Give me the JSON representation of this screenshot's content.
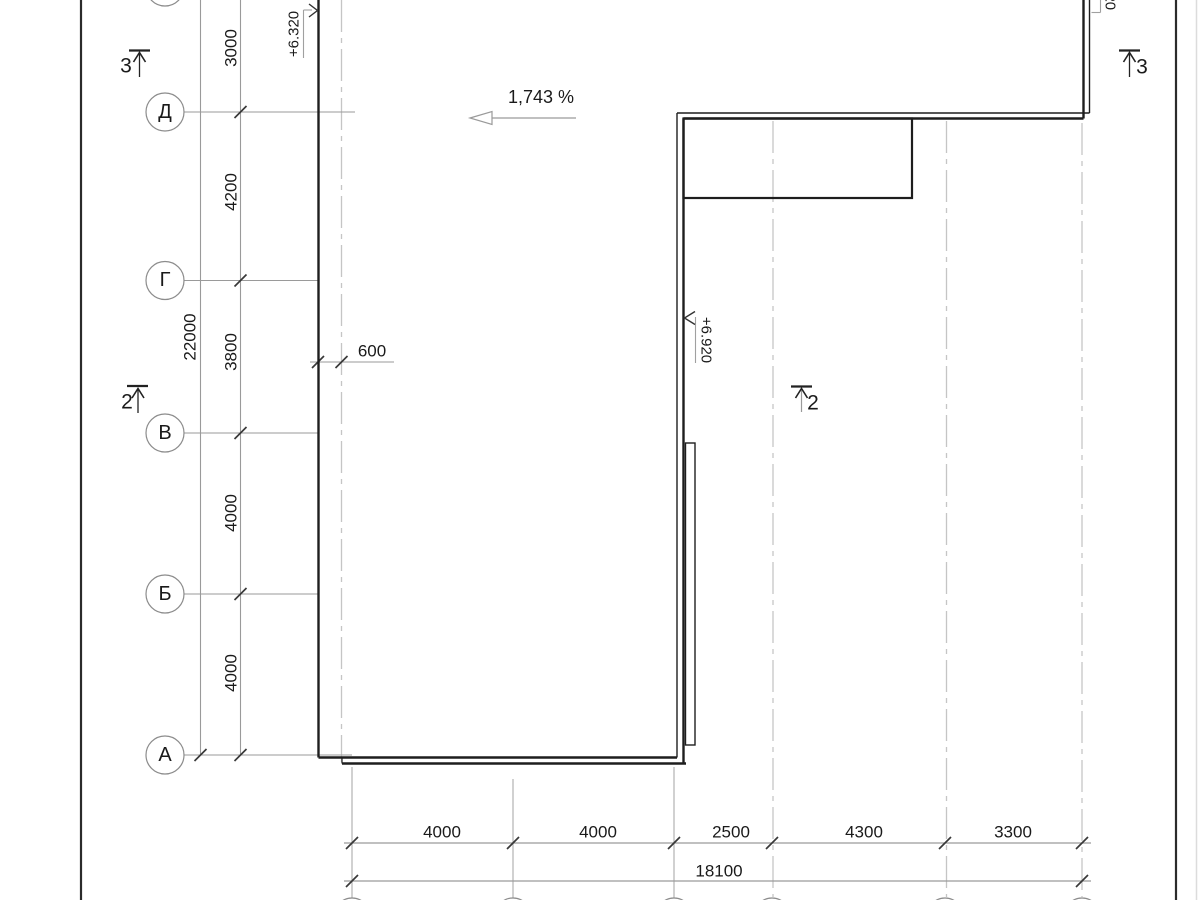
{
  "drawing": {
    "slope_label": "1,743 %",
    "overhang_dim": "600",
    "elevation_top_left": "+6.320",
    "elevation_mid": "+6.920",
    "elevation_top_right": "+6.320",
    "section_marks": {
      "top_left": "3",
      "top_right": "3",
      "mid_left": "2",
      "mid_center": "2"
    },
    "row_axes": [
      {
        "label": "Д"
      },
      {
        "label": "Г"
      },
      {
        "label": "В"
      },
      {
        "label": "Б"
      },
      {
        "label": "А"
      }
    ],
    "vertical_dims": [
      "3000",
      "4200",
      "3800",
      "4000",
      "4000"
    ],
    "vertical_total": "22000",
    "bottom_dims": [
      "4000",
      "4000",
      "2500",
      "4300",
      "3300"
    ],
    "bottom_total": "18100",
    "colors": {
      "line_dark": "#1e1e1e",
      "line_gray": "#9a9a9a",
      "grid_dash": "#c5c5c5"
    }
  }
}
